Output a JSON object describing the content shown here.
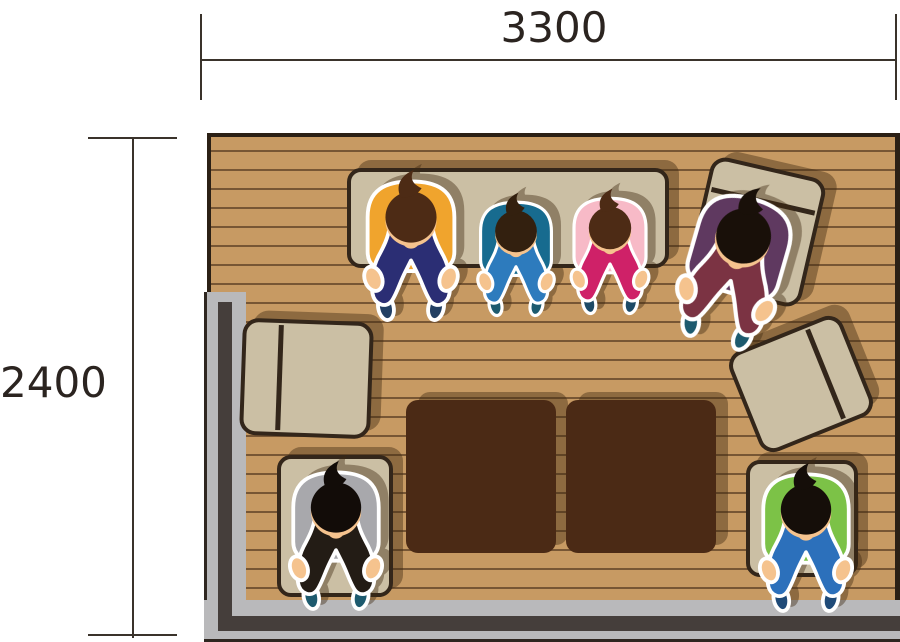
{
  "type": "top-down-living-room-floor-plan",
  "dimension_labels": {
    "top": "3300",
    "left": "2400"
  },
  "palette": {
    "floor": "#c79a63",
    "plank_line": "#775634",
    "room_border": "#2b2015",
    "wall_light": "#b9b9bb",
    "wall_dark": "#453e3b",
    "wall_outline": "#2e2620",
    "furniture_fill": "#cbbfa4",
    "furniture_border": "#33261a",
    "table_fill": "#4b2a15",
    "shadow_color": "rgba(62,40,16,0.42)",
    "dim_line": "#3a332b",
    "dim_text": "#2b2420"
  },
  "room": {
    "furniture": [
      {
        "id": "bench-top",
        "kind": "bench",
        "x": 347,
        "y": 168,
        "w": 322,
        "h": 100,
        "radius": 14,
        "rotate": 0,
        "divider": "none"
      },
      {
        "id": "armchair-top-right",
        "kind": "armchair",
        "x": 697,
        "y": 166,
        "w": 118,
        "h": 132,
        "radius": 16,
        "rotate": 13,
        "divider": "top"
      },
      {
        "id": "armchair-left",
        "kind": "armchair",
        "x": 241,
        "y": 320,
        "w": 131,
        "h": 117,
        "radius": 16,
        "rotate": 2,
        "divider": "left"
      },
      {
        "id": "armchair-right",
        "kind": "armchair",
        "x": 740,
        "y": 330,
        "w": 122,
        "h": 108,
        "radius": 16,
        "rotate": -22,
        "divider": "right"
      },
      {
        "id": "table-left-half",
        "kind": "table",
        "x": 406,
        "y": 400,
        "w": 150,
        "h": 153,
        "radius": 12,
        "rotate": 0,
        "divider": "none"
      },
      {
        "id": "table-right-half",
        "kind": "table",
        "x": 566,
        "y": 400,
        "w": 150,
        "h": 153,
        "radius": 12,
        "rotate": 0,
        "divider": "none"
      },
      {
        "id": "floor-cushion-bottom-left",
        "kind": "cushion",
        "x": 277,
        "y": 455,
        "w": 116,
        "h": 142,
        "radius": 14,
        "rotate": 0,
        "divider": "none"
      },
      {
        "id": "floor-cushion-bottom-right",
        "kind": "cushion",
        "x": 746,
        "y": 460,
        "w": 112,
        "h": 117,
        "radius": 14,
        "rotate": 0,
        "divider": "none"
      }
    ],
    "people": [
      {
        "id": "person-yellow-adult",
        "x": 358,
        "y": 164,
        "w": 106,
        "h": 164,
        "rotate": 0,
        "colors": {
          "shirt": "#f0a42d",
          "pants": "#2b2e74",
          "hair": "#4d2b15",
          "skin": "#f5c38e",
          "shoes": "#223f63"
        }
      },
      {
        "id": "person-teal-child",
        "x": 472,
        "y": 192,
        "w": 88,
        "h": 126,
        "rotate": 0,
        "colors": {
          "shirt": "#176b8f",
          "pants": "#2d7bbd",
          "hair": "#33200f",
          "skin": "#f5c38e",
          "shoes": "#1d5a6e"
        }
      },
      {
        "id": "person-pink-child",
        "x": 565,
        "y": 188,
        "w": 90,
        "h": 128,
        "rotate": 0,
        "colors": {
          "shirt": "#f7bac7",
          "pants": "#cf2168",
          "hair": "#4d2b15",
          "skin": "#f5c38e",
          "shoes": "#1d4a66"
        }
      },
      {
        "id": "person-purple-adult",
        "x": 678,
        "y": 182,
        "w": 114,
        "h": 168,
        "rotate": 16,
        "colors": {
          "shirt": "#5f3960",
          "pants": "#7b3343",
          "hair": "#191009",
          "skin": "#f5c38e",
          "shoes": "#1d5a6e"
        }
      },
      {
        "id": "person-gray-adult",
        "x": 281,
        "y": 460,
        "w": 110,
        "h": 152,
        "rotate": 0,
        "colors": {
          "shirt": "#a8a8ac",
          "pants": "#231c15",
          "hair": "#120c08",
          "skin": "#f5c38e",
          "shoes": "#1d5a6e"
        }
      },
      {
        "id": "person-green-adult",
        "x": 751,
        "y": 462,
        "w": 110,
        "h": 152,
        "rotate": 0,
        "colors": {
          "shirt": "#7cc247",
          "pants": "#2c70bb",
          "hair": "#150e09",
          "skin": "#f5c38e",
          "shoes": "#1f4a78"
        }
      }
    ]
  }
}
